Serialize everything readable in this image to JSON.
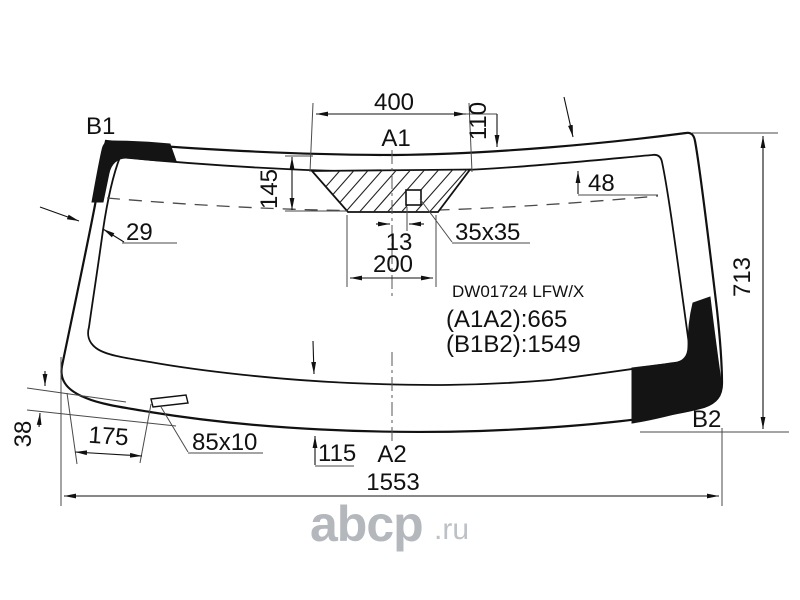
{
  "drawing": {
    "part_code": "DW01724 LFW/X",
    "distance_a1a2": "(A1A2):665",
    "distance_b1b2": "(B1B2):1549"
  },
  "points": {
    "a1": "A1",
    "a2": "A2",
    "b1": "B1",
    "b2": "B2"
  },
  "dims": {
    "mirror_top_width": "400",
    "top_edge_offset": "110",
    "mirror_band_height": "145",
    "top_band_width": "48",
    "left_edge_width": "29",
    "sensor_offset": "13",
    "sensor_size": "35x35",
    "mirror_bottom_width": "200",
    "bottom_band_width": "115",
    "slot_horizontal_offset": "175",
    "slot_vertical_offset": "38",
    "slot_size": "85x10",
    "glass_width": "1553",
    "glass_height": "713"
  },
  "watermark": {
    "brand": "abcp",
    "suffix": ".ru",
    "color": "#b4b8bc"
  },
  "colors": {
    "line": "#111111",
    "shade_patch": "#141414",
    "background": "#ffffff"
  }
}
